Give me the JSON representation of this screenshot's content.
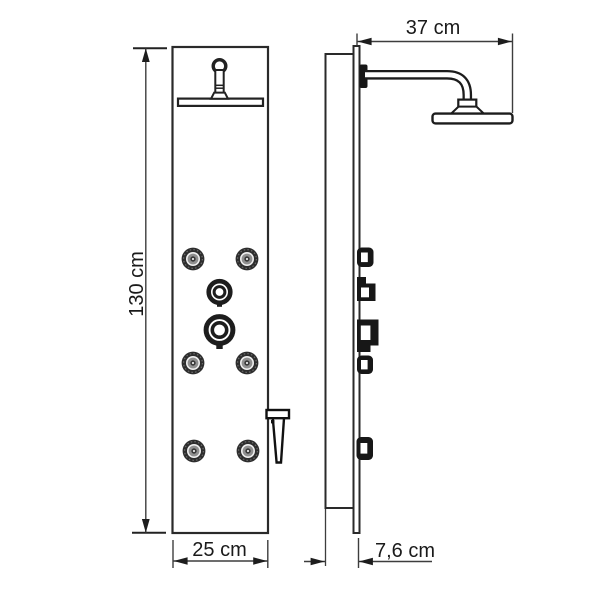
{
  "diagram": {
    "title": "shower panel technical drawing, front and side views with dimensions",
    "views": {
      "front": {
        "height_label": "130 cm",
        "width_label": "25 cm",
        "jet_count": 6,
        "dial_count": 2
      },
      "side": {
        "arm_label": "37 cm",
        "depth_label": "7,6 cm",
        "knob_count": 5
      }
    },
    "colors": {
      "background": "#ffffff",
      "outline": "#2a2a2a",
      "dimension_line": "#3d3d3d",
      "arrow": "#1d1d1d",
      "text": "#1a1a1a",
      "jet_dark": "#2d2d2d",
      "jet_light": "#efefef",
      "jet_mid": "#909090",
      "solid_part": "#171717"
    }
  }
}
